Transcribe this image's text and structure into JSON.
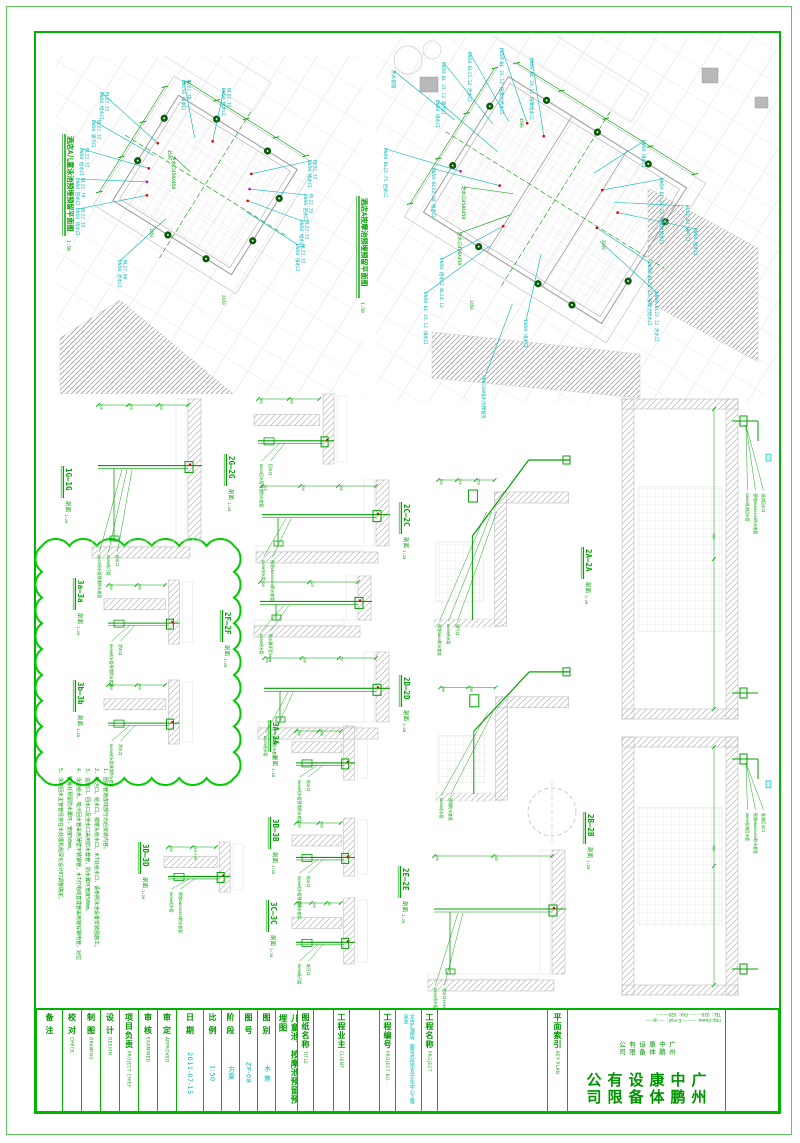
{
  "sheet": {
    "bg": "#ffffff",
    "border_outer": "#5fc95f",
    "border_inner": "#00b400",
    "accent_green": "#00a000",
    "accent_cyan": "#00b6b6",
    "cloud_green": "#00cc00"
  },
  "plans": [
    {
      "title": "酒店A儿童泳池预埋预留平面图",
      "scale": "1:50",
      "title_pos": [
        68,
        136
      ],
      "geom": {
        "cx": 205,
        "cy": 185,
        "rot": 32,
        "pw": 140,
        "ph": 124,
        "region": [
          56,
          56,
          306,
          338
        ]
      },
      "ports": [
        [
          -70,
          -35
        ],
        [
          -70,
          15
        ],
        [
          -25,
          -62
        ],
        [
          35,
          -62
        ],
        [
          70,
          -28
        ],
        [
          70,
          22
        ],
        [
          -5,
          62
        ],
        [
          40,
          62
        ]
      ],
      "hatch": [
        [
          120,
          300,
          236,
          396,
          60,
          396,
          60,
          338
        ]
      ],
      "dims": [
        {
          "t": "4500",
          "x": 168,
          "y": 150
        },
        {
          "t": "2470",
          "x": 222,
          "y": 295
        },
        {
          "t": "1450",
          "x": 150,
          "y": 228
        }
      ],
      "labels": [
        {
          "t": "DN50 给水口",
          "s": "BL22.32",
          "x": 100,
          "y": 92
        },
        {
          "t": "DN150 排水口",
          "s": "BL22.30",
          "x": 182,
          "y": 80
        },
        {
          "t": "DN50 给水口",
          "s": "BL22.32",
          "x": 222,
          "y": 88
        },
        {
          "t": "DN50 吸污口",
          "s": "BL22.32",
          "x": 92,
          "y": 120
        },
        {
          "t": "DN50 给水口",
          "s": "BL22.32",
          "x": 80,
          "y": 148
        },
        {
          "t": "DN50 回水口",
          "s": "BL22.70",
          "x": 76,
          "y": 178
        },
        {
          "t": "DN50 给水口",
          "s": "BL22.32",
          "x": 76,
          "y": 208
        },
        {
          "t": "泄水口450X450",
          "s": "",
          "x": 172,
          "y": 156,
          "c": "#00a000"
        },
        {
          "t": "DN50 给水口",
          "s": "BL22.32",
          "x": 308,
          "y": 160
        },
        {
          "t": "DN50 回水口",
          "s": "BL22.35",
          "x": 304,
          "y": 194
        },
        {
          "t": "DN50 给水口",
          "s": "BL22.32",
          "x": 300,
          "y": 220
        },
        {
          "t": "DN50 排水口",
          "s": "BL22.32",
          "x": 296,
          "y": 244
        },
        {
          "t": "DN50 泄水口",
          "s": "BL22.60",
          "x": 118,
          "y": 260
        }
      ]
    },
    {
      "title": "酒店A按摩池预埋预留平面图",
      "scale": "1:50",
      "title_pos": [
        362,
        198
      ],
      "geom": {
        "cx": 555,
        "cy": 200,
        "rot": 32,
        "pw": 210,
        "ph": 160,
        "region": [
          376,
          36,
          402,
          366
        ]
      },
      "ports": [
        [
          -105,
          -45
        ],
        [
          -105,
          25
        ],
        [
          -60,
          -80
        ],
        [
          0,
          -80
        ],
        [
          60,
          -80
        ],
        [
          105,
          -40
        ],
        [
          105,
          30
        ],
        [
          -40,
          80
        ],
        [
          30,
          80
        ],
        [
          70,
          80
        ]
      ],
      "hatch": [
        [
          648,
          188,
          758,
          248,
          758,
          362,
          648,
          302
        ],
        [
          432,
          332,
          640,
          354,
          640,
          398,
          432,
          378
        ]
      ],
      "squares": [
        [
          420,
          77,
          18,
          15
        ],
        [
          702,
          68,
          16,
          15
        ],
        [
          755,
          97,
          13,
          11
        ]
      ],
      "dims": [
        {
          "t": "4500",
          "x": 520,
          "y": 118
        },
        {
          "t": "2050",
          "x": 602,
          "y": 240
        },
        {
          "t": "1450",
          "x": 470,
          "y": 300
        }
      ],
      "labels": [
        {
          "t": "DN50 BL 23.12 按摩池给水口",
          "x": 500,
          "y": 48
        },
        {
          "t": "DN50 BL23.12 泄水口",
          "x": 468,
          "y": 52
        },
        {
          "t": "DN50 BL 23.12 吸污口",
          "x": 442,
          "y": 62
        },
        {
          "t": "DN50 BL 23.12 按摩给水口",
          "x": 530,
          "y": 58
        },
        {
          "t": "热水管道",
          "x": 392,
          "y": 70
        },
        {
          "t": "DN50 排水口",
          "x": 436,
          "y": 100
        },
        {
          "t": "DN50 BL22.75 回水口",
          "x": 384,
          "y": 148
        },
        {
          "t": "DN50 BL23.10 给水口",
          "x": 432,
          "y": 168
        },
        {
          "t": "泄水口450X450",
          "x": 462,
          "y": 186,
          "c": "#00a000"
        },
        {
          "t": "DN50 排水口",
          "x": 642,
          "y": 140
        },
        {
          "t": "DN50 BL 23.12 按摩池给水口",
          "x": 660,
          "y": 178
        },
        {
          "t": "BL21.67 通气口",
          "x": 686,
          "y": 205
        },
        {
          "t": "DN50 给水口",
          "x": 694,
          "y": 228
        },
        {
          "t": "泄水口450X450",
          "x": 458,
          "y": 232,
          "c": "#00a000"
        },
        {
          "t": "DN50 给水口 BL23.12",
          "x": 440,
          "y": 258
        },
        {
          "t": "DN50 BC 23.12 排水口",
          "x": 424,
          "y": 292
        },
        {
          "t": "DN50 BL23.12 按摩池给水口",
          "x": 648,
          "y": 262
        },
        {
          "t": "DN50 BL23.12 泄水口",
          "x": 655,
          "y": 292
        },
        {
          "t": "DN50 排水口",
          "x": 524,
          "y": 320
        },
        {
          "t": "DN150排水沟预留孔",
          "x": 482,
          "y": 378
        }
      ]
    }
  ],
  "sections": [
    {
      "t": "1G—1G",
      "suffix": "剖面",
      "scale": "1:20",
      "tx": 66,
      "ty": 468,
      "box": [
        88,
        395,
        118,
        168
      ],
      "kind": "corner",
      "dims": [
        "220",
        "250",
        "300"
      ],
      "labels": [
        "DN25给水管预埋防水套管",
        "DN50吸污管",
        "给水口"
      ]
    },
    {
      "t": "2G—2G",
      "suffix": "剖面",
      "scale": "1:20",
      "tx": 229,
      "ty": 456,
      "box": [
        250,
        390,
        126,
        82
      ],
      "kind": "floor",
      "dims": [
        "300",
        "100"
      ],
      "labels": [
        "DN25回水管预埋防水套管",
        "回水口"
      ]
    },
    {
      "t": "2C—2C",
      "suffix": "剖面",
      "scale": "1:20",
      "tx": 404,
      "ty": 504,
      "box": [
        252,
        476,
        142,
        92
      ],
      "kind": "corner",
      "dims": [
        "750",
        "100",
        "100"
      ],
      "labels": [
        "DN50排水管",
        "预埋DN80X450防水套管"
      ]
    },
    {
      "t": "2F—2F",
      "suffix": "剖面",
      "scale": "1:20",
      "tx": 225,
      "ty": 612,
      "box": [
        250,
        572,
        126,
        70
      ],
      "kind": "corner",
      "dims": [
        "300",
        "120"
      ],
      "labels": [
        "DN50给水管",
        "防水翼环宽50mm"
      ]
    },
    {
      "t": "2D—2D",
      "suffix": "剖面",
      "scale": "1:20",
      "tx": 404,
      "ty": 677,
      "box": [
        254,
        648,
        140,
        96
      ],
      "kind": "corner",
      "dims": [
        "300",
        "100",
        "50"
      ],
      "labels": [
        "DN25给水管",
        "预埋防水套管"
      ]
    },
    {
      "t": "3A—3A",
      "suffix": "剖面",
      "scale": "1:20",
      "tx": 273,
      "ty": 722,
      "box": [
        288,
        722,
        96,
        66
      ],
      "kind": "floor",
      "dims": [
        "150",
        "400"
      ],
      "labels": [
        "DN50给水管预埋防水套管",
        "给水口"
      ]
    },
    {
      "t": "3B—3B",
      "suffix": "剖面",
      "scale": "1:20",
      "tx": 273,
      "ty": 819,
      "box": [
        288,
        814,
        96,
        70
      ],
      "kind": "floor",
      "dims": [
        "150",
        "400"
      ],
      "labels": [
        "DN50给水管预埋防水套管",
        "给水口"
      ]
    },
    {
      "t": "3C—3C",
      "suffix": "剖面",
      "scale": "1:20",
      "tx": 271,
      "ty": 902,
      "box": [
        288,
        894,
        96,
        78
      ],
      "kind": "floor",
      "dims": [
        "300",
        "100",
        "50"
      ],
      "labels": [
        "DN50吸污管",
        "吸污口"
      ]
    },
    {
      "t": "3D—3D",
      "suffix": "剖面",
      "scale": "1:20",
      "tx": 143,
      "ty": 844,
      "box": [
        160,
        838,
        102,
        62
      ],
      "kind": "floor",
      "dims": [
        "400",
        "250~100"
      ],
      "labels": [
        "DN50给水管",
        "预埋DN80X450防水套管"
      ]
    },
    {
      "t": "3a—3a",
      "suffix": "剖面",
      "scale": "1:20",
      "tx": 78,
      "ty": 580,
      "box": [
        100,
        576,
        118,
        76
      ],
      "kind": "floor",
      "dims": [
        "300",
        "400"
      ],
      "labels": [
        "DN50给水管预埋防水套管",
        "泄水口"
      ]
    },
    {
      "t": "3b—3b",
      "suffix": "剖面",
      "scale": "1:20",
      "tx": 78,
      "ty": 682,
      "box": [
        100,
        676,
        118,
        76
      ],
      "kind": "floor",
      "dims": [
        "300",
        "400"
      ],
      "labels": [
        "DN50给水管预埋防水套管",
        "泄水口"
      ]
    },
    {
      "t": "2A—2A",
      "suffix": "剖面",
      "scale": "1:20",
      "tx": 586,
      "ty": 549,
      "box": [
        428,
        432,
        148,
        200
      ],
      "kind": "pipeup",
      "dims": [
        "300",
        "150",
        "950"
      ],
      "labels": [
        "预埋DN80防水套管",
        "DN50给水管",
        "通气口"
      ]
    },
    {
      "t": "",
      "suffix": "",
      "scale": "",
      "tx": 0,
      "ty": 0,
      "box": [
        430,
        650,
        146,
        156
      ],
      "kind": "pipeup",
      "dims": [
        "300",
        "200"
      ],
      "labels": [
        "DN50给水管",
        "预埋防水套管"
      ]
    },
    {
      "t": "2E—2E",
      "suffix": "剖面",
      "scale": "1:20",
      "tx": 403,
      "ty": 868,
      "box": [
        424,
        846,
        146,
        150
      ],
      "kind": "corner",
      "dims": [
        "200",
        "100"
      ],
      "labels": [
        "DN50排水管",
        "泄水口450X450"
      ]
    },
    {
      "t": "",
      "suffix": "",
      "scale": "",
      "tx": 0,
      "ty": 0,
      "box": [
        616,
        395,
        164,
        328
      ],
      "kind": "tall",
      "dims": [
        "785",
        "300",
        "1050"
      ],
      "labels": [
        "DN50溢流回水管",
        "预埋DN80X450防水套管",
        "溢流回水口"
      ]
    },
    {
      "t": "2B—2B",
      "suffix": "剖面",
      "scale": "1:20",
      "tx": 588,
      "ty": 814,
      "box": [
        616,
        733,
        164,
        266
      ],
      "kind": "tall",
      "dims": [
        "785",
        "300",
        "1050"
      ],
      "labels": [
        "DN50溢流回水管",
        "预埋DN80X450防水套管",
        "溢流回水口"
      ]
    }
  ],
  "cloud": {
    "x": 42,
    "y": 546,
    "w": 192,
    "h": 232
  },
  "misc": {
    "dashed_circle": [
      552,
      812,
      24
    ]
  },
  "notes": {
    "x": 104,
    "y": 768,
    "items": [
      "1. 图中管道虚线部分为后安装内容。",
      "2. 吸污口、给水口、按摩头给水口、水T处给水口，请参照泳池设备安装图施工。",
      "3. 溢流口、回水口及泄水口采用防水套管，防水翼环宽度50mm。",
      "4. 泳池给水、吸污回水管采用薄壁不锈钢管，水T灯电线直埋管采用镀锌钢电管，对拉管每处预留防水翼环，宽度50mm。",
      "5. 泳池回水主管管径将在水处理机组深化设计时调整确定。"
    ]
  },
  "titleblock": {
    "x": 35,
    "y": 1008,
    "w": 745,
    "h": 105,
    "columns": [
      {
        "w": 26,
        "label": "备 注"
      },
      {
        "w": 19,
        "label": "校 对",
        "sub": "CHECK"
      },
      {
        "w": 19,
        "label": "制 图",
        "sub": "DRAWING"
      },
      {
        "w": 19,
        "label": "设 计",
        "sub": "DESIGN"
      },
      {
        "w": 19,
        "label": "项目负责",
        "sub": "PROJECT CHIEF"
      },
      {
        "w": 19,
        "label": "审 核",
        "sub": "EXAMINED"
      },
      {
        "w": 19,
        "label": "审 定",
        "sub": "APPROVED"
      },
      {
        "w": 27,
        "label": "日 期",
        "value": "2011-07-15"
      },
      {
        "w": 18,
        "label": "比 例",
        "value": "1:50"
      },
      {
        "w": 18,
        "label": "阶 段",
        "value": "方案"
      },
      {
        "w": 18,
        "label": "图 号",
        "value": "ZP-08"
      },
      {
        "w": 18,
        "label": "图 别",
        "value": "水 施"
      },
      {
        "w": 22,
        "big": "儿童池、按摩池预留预埋图"
      },
      {
        "w": 16,
        "label": "图纸名称",
        "sub": "TITLE"
      },
      {
        "w": 20
      },
      {
        "w": 16,
        "label": "工程业主",
        "sub": "CLIENT"
      },
      {
        "w": 30
      },
      {
        "w": 16,
        "label": "工程编号",
        "sub": "PROJECT NO."
      },
      {
        "w": 26,
        "cyan": "太古汇酒店、服务式住宅及文化中心工程泳池"
      },
      {
        "w": 16,
        "label": "工程名称",
        "sub": "PROJECT"
      },
      {
        "w": 110,
        "keyplan": true
      },
      {
        "w": 20,
        "label": "平面索引",
        "sub": "KEY PLAN"
      },
      {
        "w": 158,
        "company": true
      },
      {
        "w": 56
      }
    ],
    "company": {
      "name": "广州中鹏康体设备有限公司",
      "name_small": "广州中鹏康体设备有限公司",
      "contact1": "TEL：020-········· FAX：020-·········",
      "contact2": "http://www.············ E-mail：······@······"
    }
  }
}
